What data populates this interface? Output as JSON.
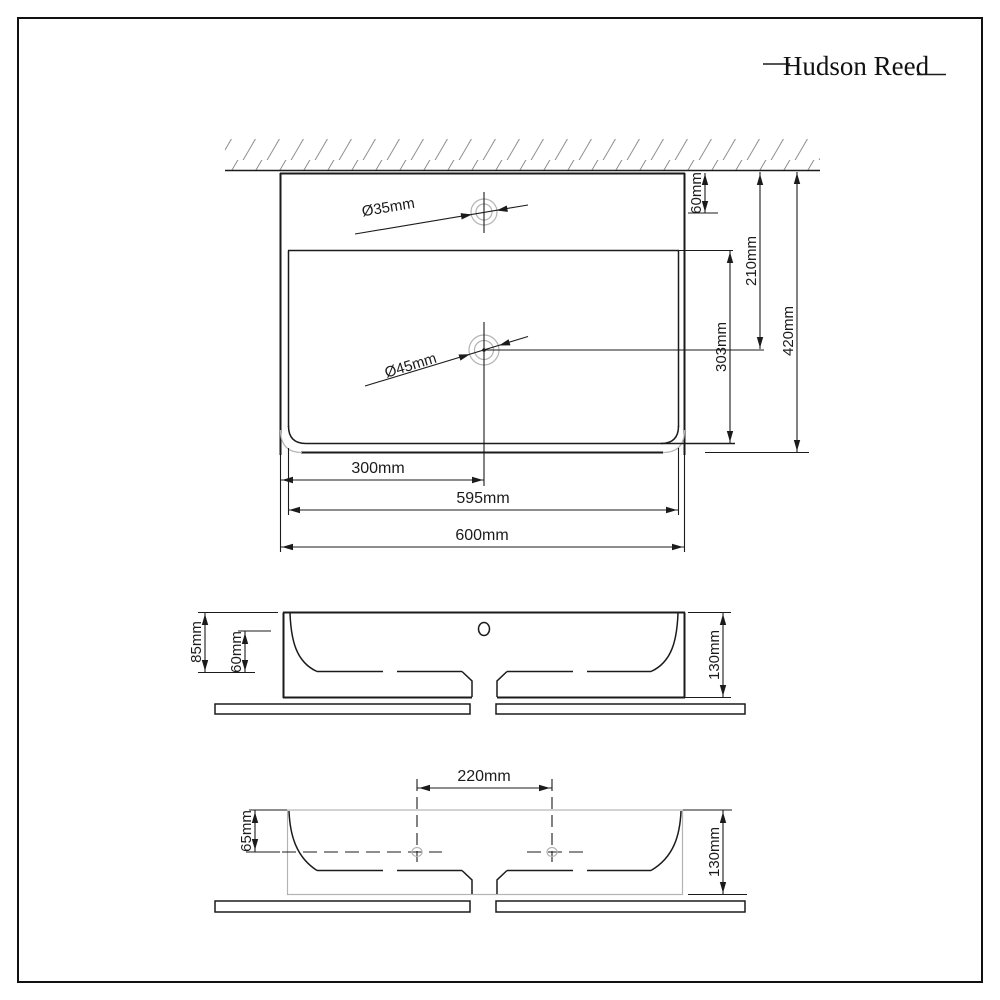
{
  "logo": {
    "text": "Hudson Reed"
  },
  "colors": {
    "line": "#1b1b1b",
    "light_gray": "#b3b3b3",
    "hatch": "#8f8f8f",
    "background": "#ffffff"
  },
  "top_view": {
    "tap_hole_diameter": "Ø35mm",
    "waste_hole_diameter": "Ø45mm",
    "tap_setback": "60mm",
    "waste_setback": "210mm",
    "bowl_depth_plan": "303mm",
    "overall_depth": "420mm",
    "waste_offset_left": "300mm",
    "bowl_width": "595mm",
    "overall_width": "600mm"
  },
  "front_view": {
    "bowl_depth": "85mm",
    "inner_depth": "60mm",
    "overall_height": "130mm"
  },
  "underside_view": {
    "fixing_hole_centres": "220mm",
    "ledge_height": "65mm",
    "overall_height": "130mm"
  }
}
